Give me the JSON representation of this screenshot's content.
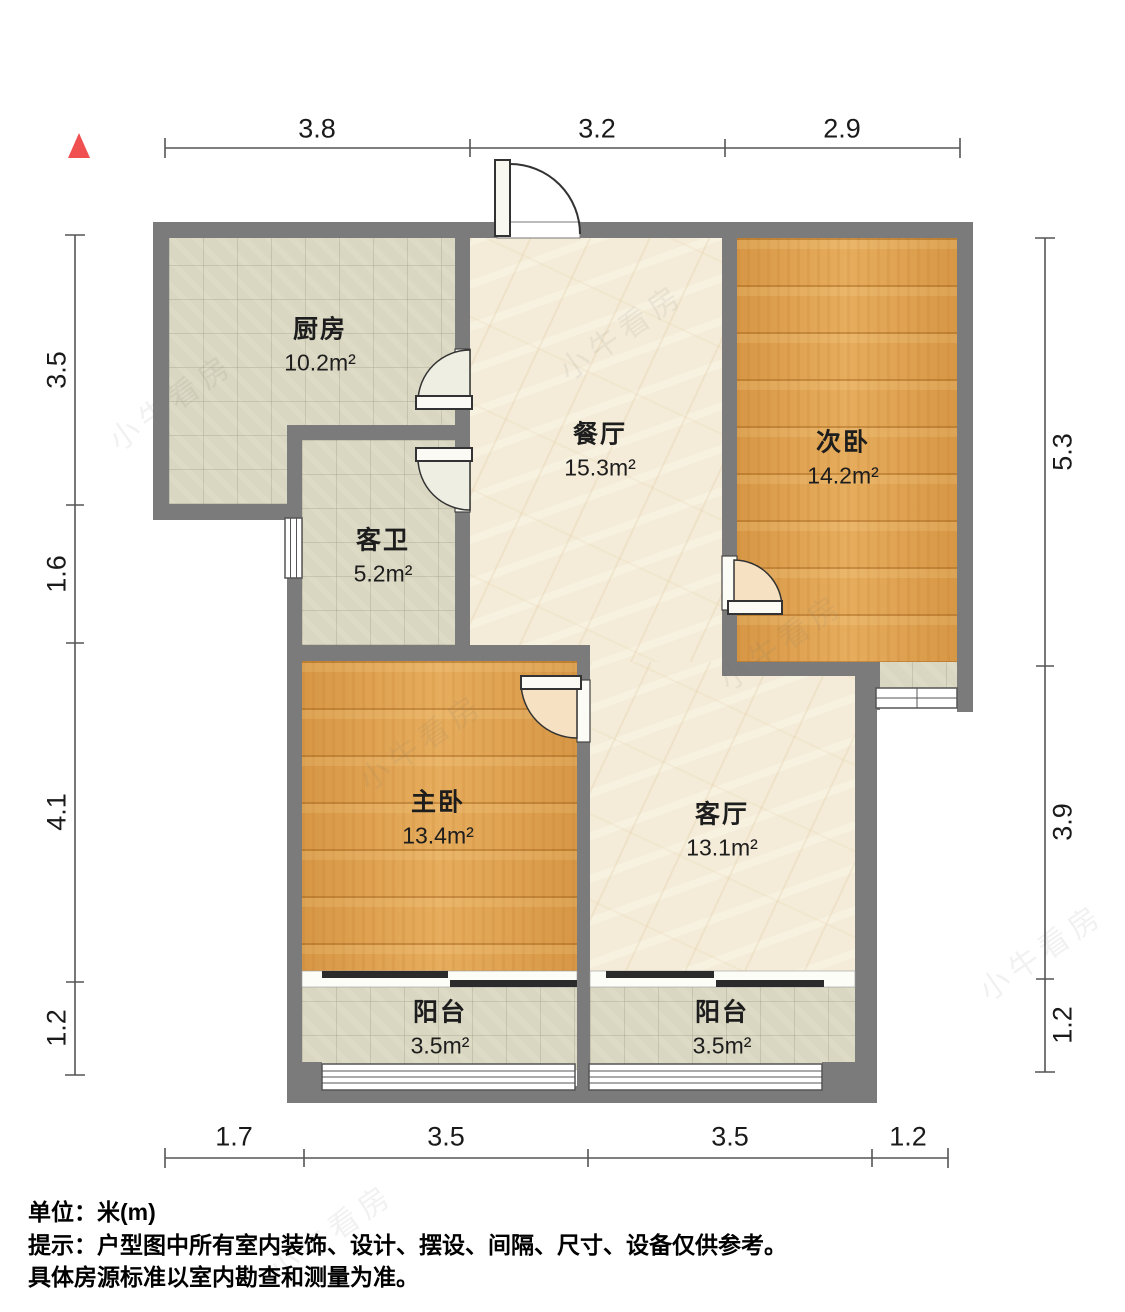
{
  "watermark": {
    "text": "小牛看房"
  },
  "dims": {
    "top": [
      "3.8",
      "3.2",
      "2.9"
    ],
    "bottom": [
      "1.7",
      "3.5",
      "3.5",
      "1.2"
    ],
    "left": [
      "3.5",
      "1.6",
      "4.1",
      "1.2"
    ],
    "right": [
      "5.3",
      "3.9",
      "1.2"
    ]
  },
  "rooms": {
    "kitchen": {
      "name": "厨房",
      "area": "10.2m²"
    },
    "dining": {
      "name": "餐厅",
      "area": "15.3m²"
    },
    "bedroom2": {
      "name": "次卧",
      "area": "14.2m²"
    },
    "bath": {
      "name": "客卫",
      "area": "5.2m²"
    },
    "master": {
      "name": "主卧",
      "area": "13.4m²"
    },
    "living": {
      "name": "客厅",
      "area": "13.1m²"
    },
    "balcony1": {
      "name": "阳台",
      "area": "3.5m²"
    },
    "balcony2": {
      "name": "阳台",
      "area": "3.5m²"
    }
  },
  "footer": {
    "unit": "单位：米(m)",
    "tip1": "提示：户型图中所有室内装饰、设计、摆设、间隔、尺寸、设备仅供参考。",
    "tip2": "具体房源标准以室内勘查和测量为准。"
  },
  "colors": {
    "wall": "#7b7b7b",
    "wood": "#e1a14d",
    "tile": "#d9d6c1",
    "marble": "#f4ecd8",
    "north_arrow": "#f05050"
  }
}
